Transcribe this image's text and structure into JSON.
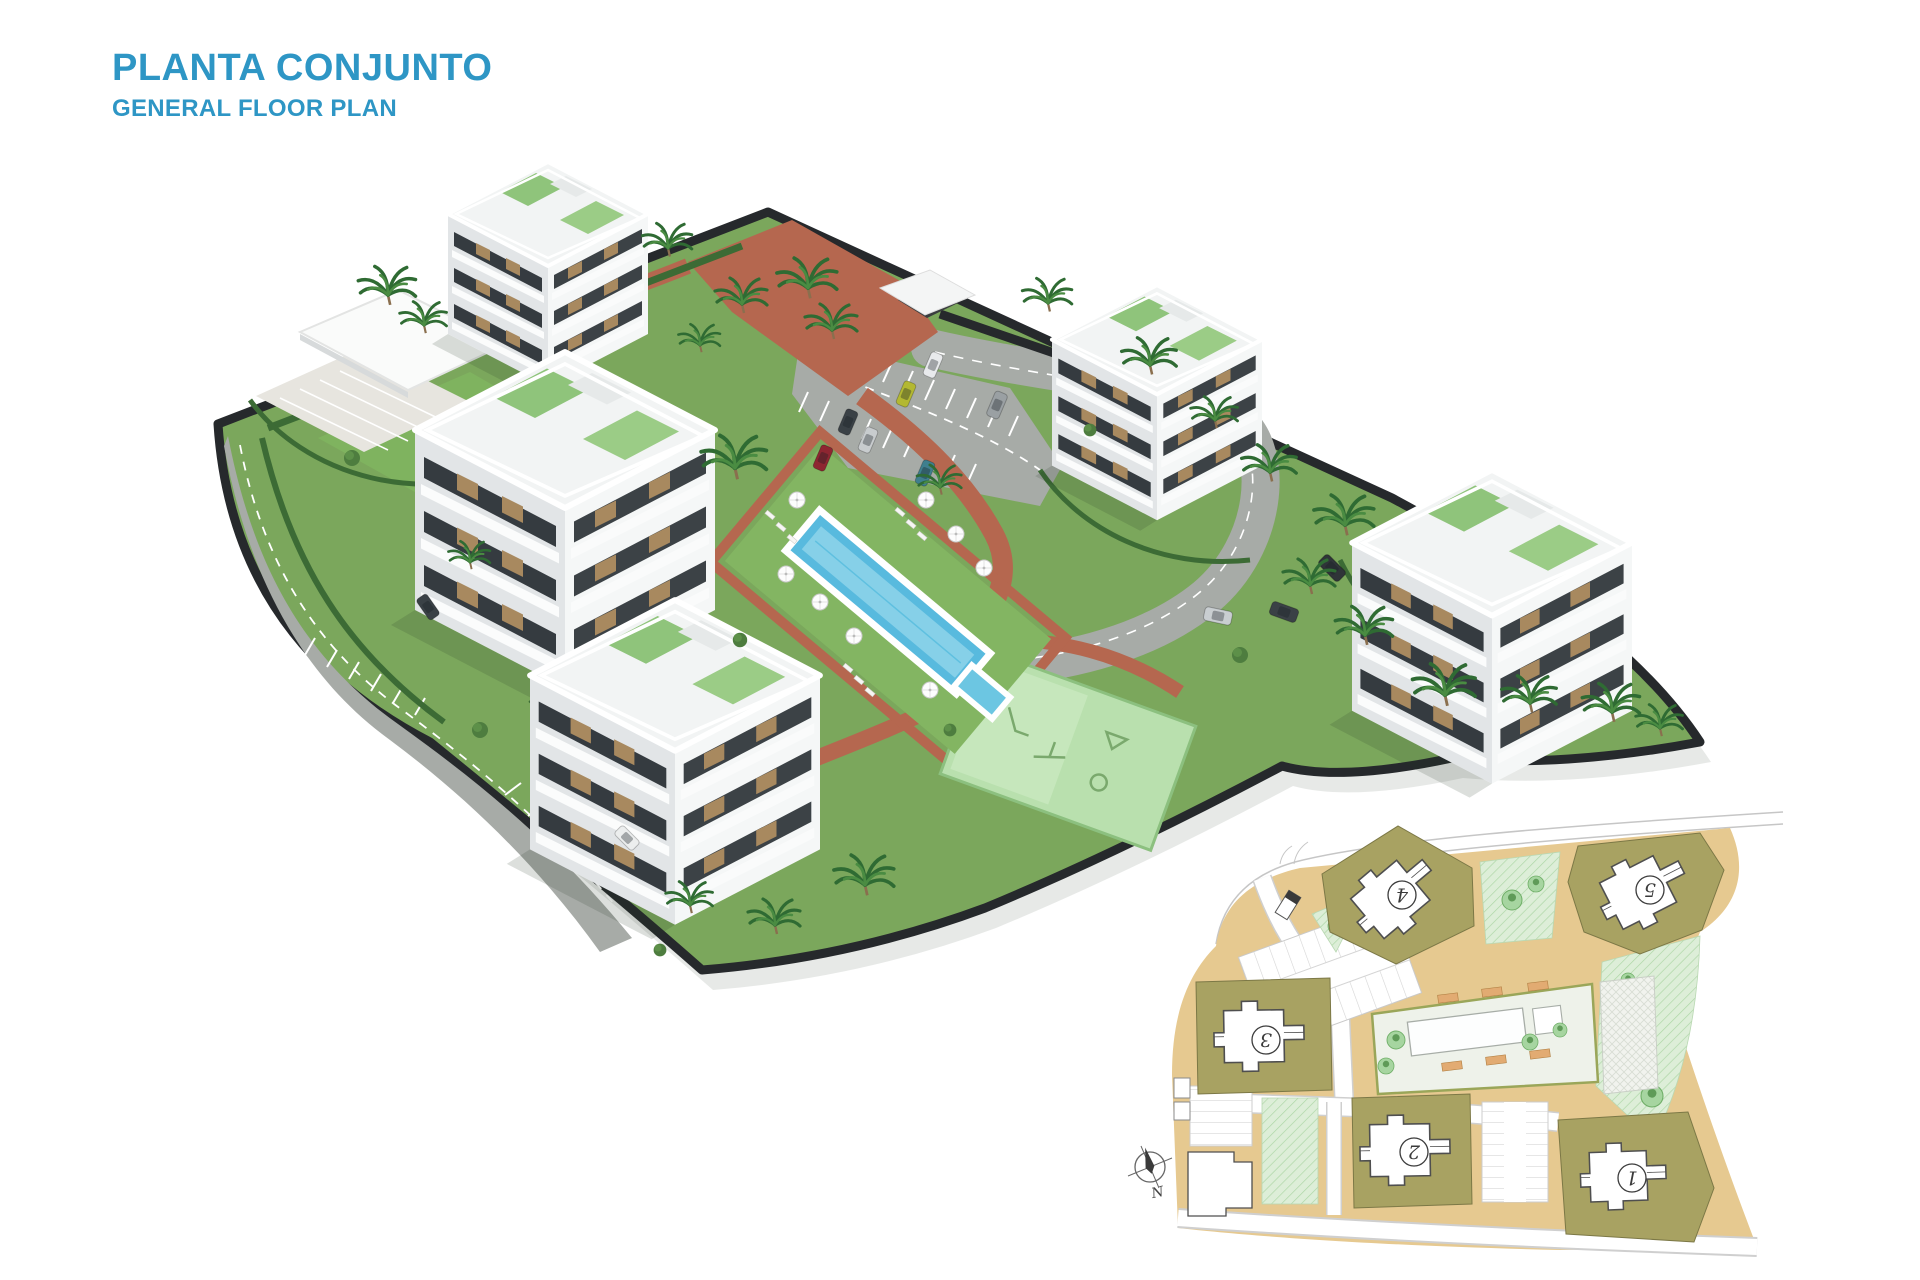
{
  "header": {
    "title": "PLANTA CONJUNTO",
    "subtitle": "GENERAL FLOOR PLAN"
  },
  "render_3d": {
    "building_count": 5,
    "features": [
      "apartment-buildings",
      "clubhouse",
      "swimming-pool",
      "kids-pool",
      "playground",
      "parking-lots",
      "palm-trees",
      "perimeter-road"
    ]
  },
  "inset_plan": {
    "buildings": [
      {
        "label": "1"
      },
      {
        "label": "2"
      },
      {
        "label": "3"
      },
      {
        "label": "4"
      },
      {
        "label": "5"
      }
    ],
    "north_label": "N"
  },
  "icons": {
    "north-arrow-icon": "compass star with N label",
    "palm-tree-icon": "radiating fronds",
    "umbrella-icon": "white parasol disc",
    "car-icon": "small vehicle glyph"
  },
  "palette": {
    "title_blue": "#2E96C5",
    "lawn_green": "#7BA75C",
    "brick_path": "#B5674F",
    "road_gray": "#A7ABA7",
    "pool_blue": "#58BADE",
    "playground_mint": "#B9E0AE",
    "perimeter_dark": "#26292C",
    "inset_tan": "#E6C990",
    "inset_olive": "#A8A262",
    "inset_green": "#DDEED8",
    "building_white": "#F4F6F6"
  }
}
